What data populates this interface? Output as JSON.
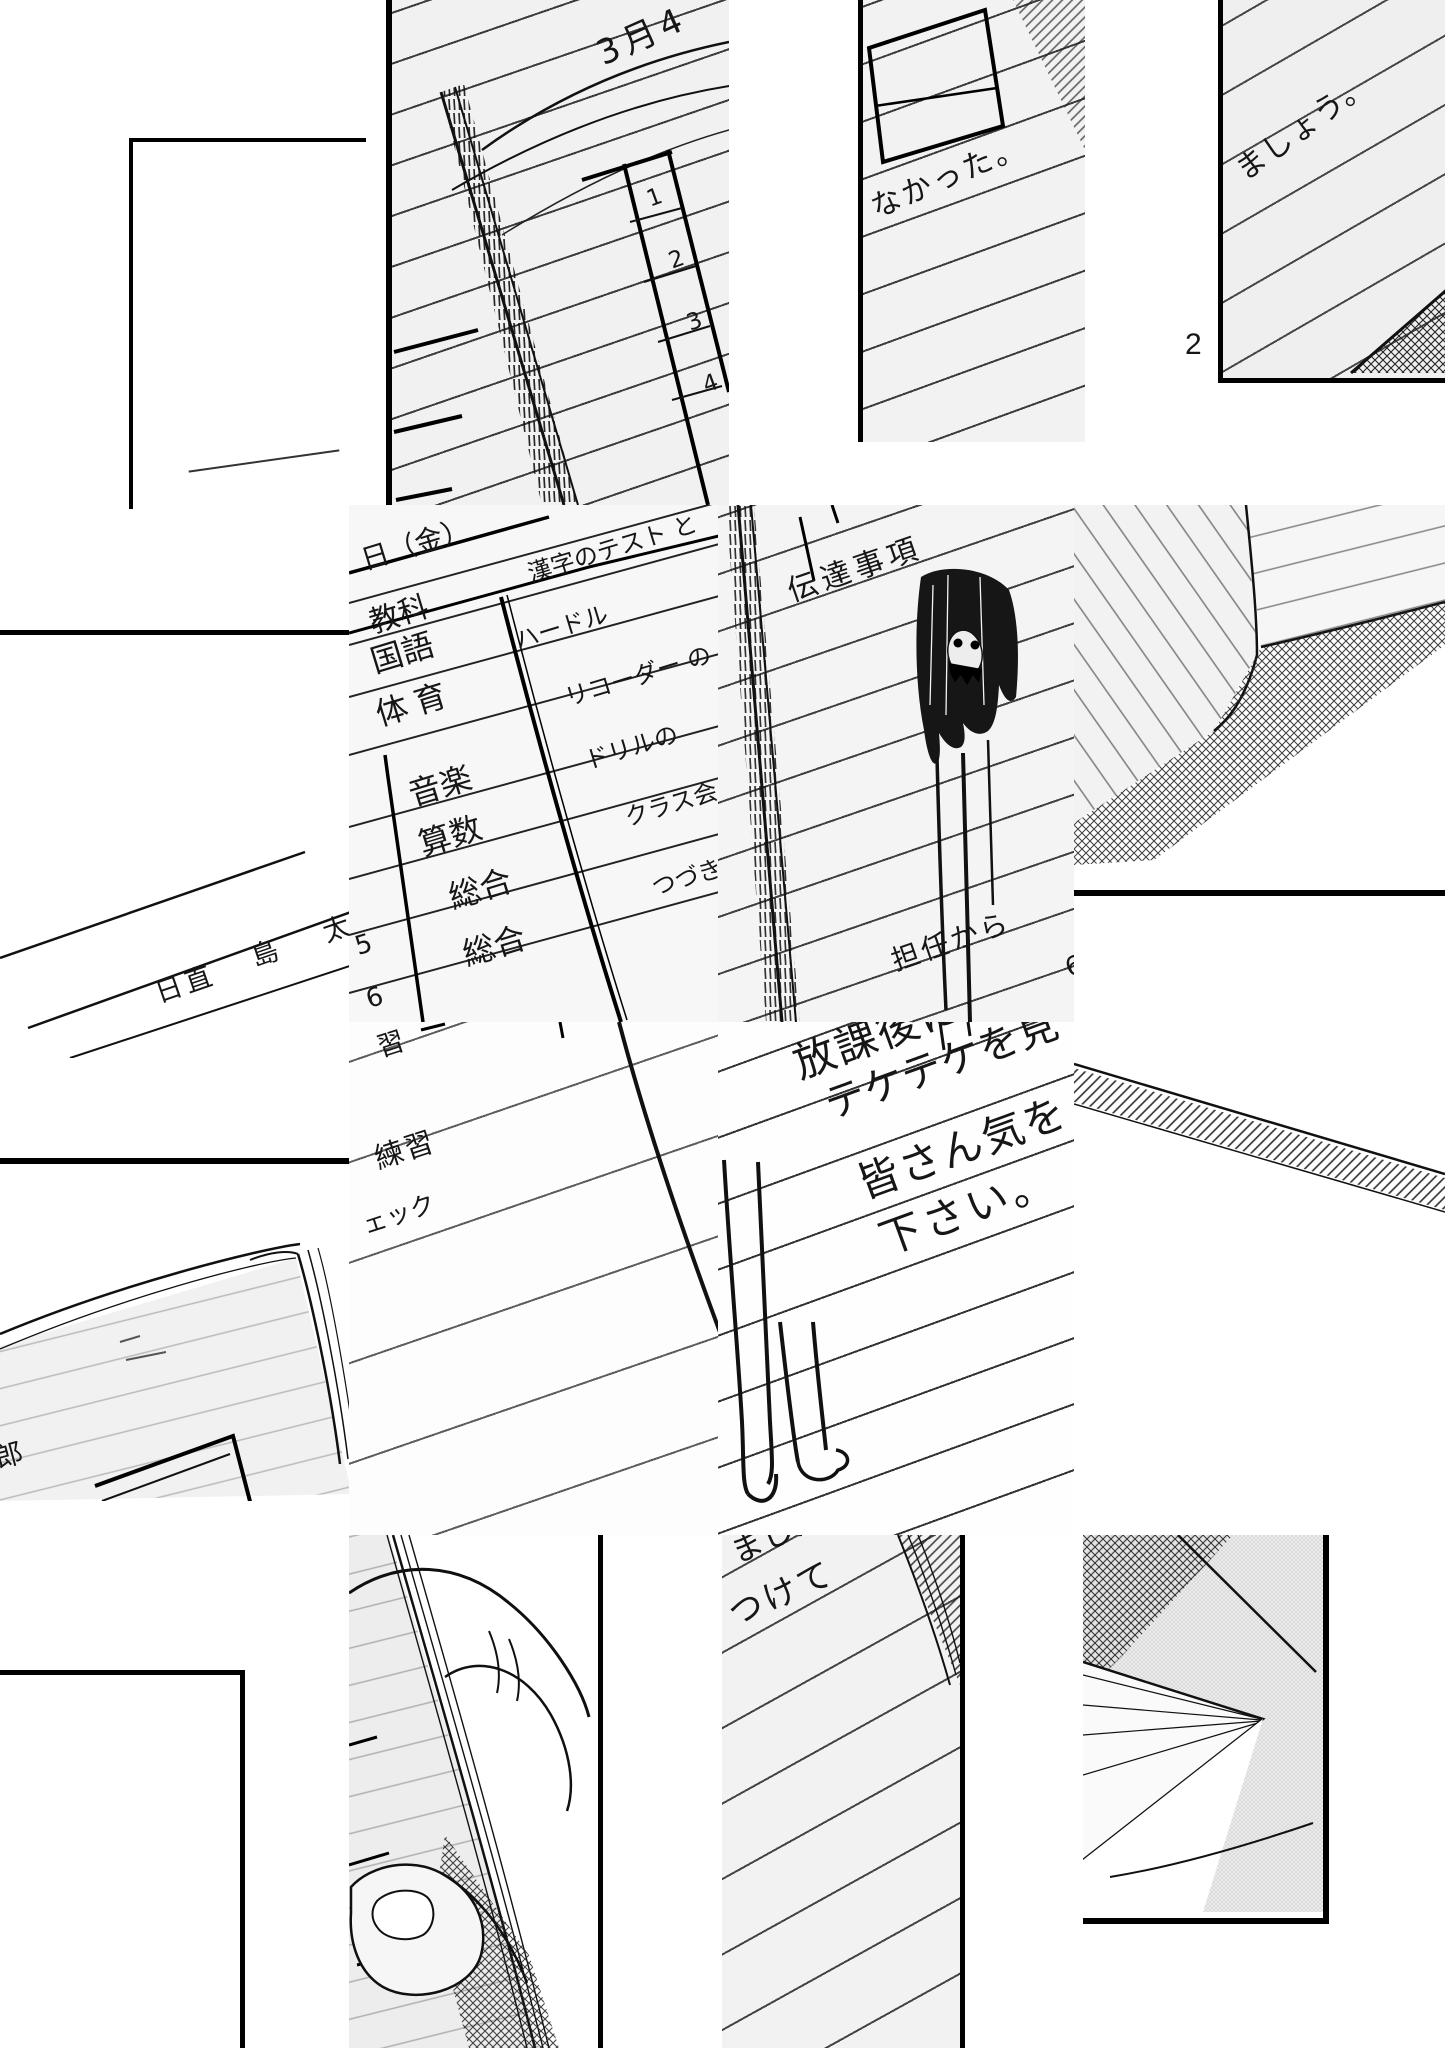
{
  "page": {
    "number": "2"
  },
  "notebook_top": {
    "date": "3月4",
    "row_numbers": [
      "1",
      "2",
      "3",
      "4"
    ]
  },
  "fragment_nakatta": "なかった。",
  "fragment_mashou": "ましょう。",
  "schedule": {
    "day_heading": "日（金）",
    "column_header": "教科",
    "subjects": [
      "国語",
      "体育",
      "音楽",
      "算数",
      "総合",
      "総合"
    ],
    "activities": [
      "漢字のテスト と",
      "ハードル",
      "リコーダー の",
      "ドリルの",
      "クラス会",
      "つづき"
    ],
    "period_numbers": [
      "5",
      "6"
    ]
  },
  "duty": {
    "label": "日直",
    "name_fragment": "島 太",
    "name_fragment2": "郎"
  },
  "notice": {
    "header": "伝達事項",
    "from_teacher": "担任から",
    "digit_fragment": "6"
  },
  "practice": {
    "fragment_top": "習",
    "label": "練習",
    "check_fragment": "ェック"
  },
  "teacher_message": [
    "放課後に",
    "テケテケを見",
    "皆さん気を",
    "下さい。"
  ],
  "fragment_mashita": "ました。",
  "fragment_tsukete": "つけて"
}
